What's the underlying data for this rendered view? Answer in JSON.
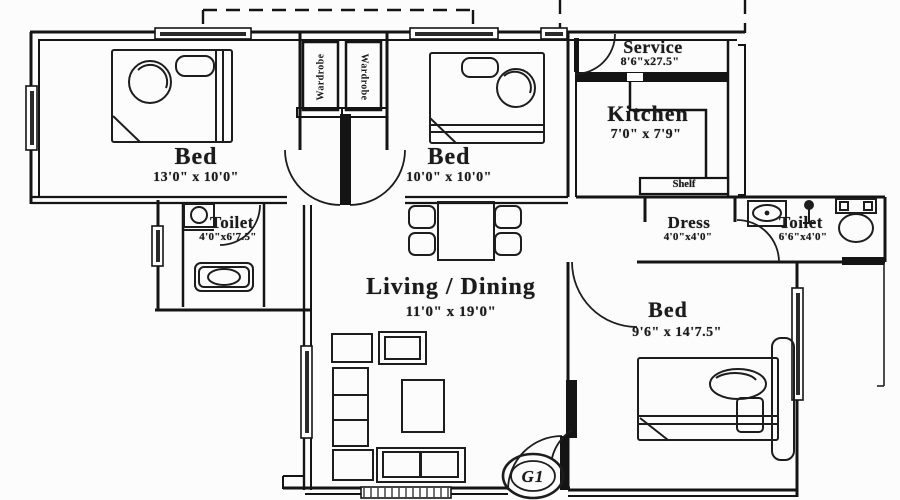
{
  "rooms": {
    "bed1": {
      "name": "Bed",
      "dims": "13'0\" x 10'0\""
    },
    "bed2": {
      "name": "Bed",
      "dims": "10'0\" x 10'0\""
    },
    "bed3": {
      "name": "Bed",
      "dims": "9'6\" x 14'7.5\""
    },
    "living": {
      "name": "Living / Dining",
      "dims": "11'0\" x 19'0\""
    },
    "kitchen": {
      "name": "Kitchen",
      "dims": "7'0\" x 7'9\""
    },
    "service": {
      "name": "Service",
      "dims": "8'6\"x27.5\""
    },
    "toilet_left": {
      "name": "Toilet",
      "dims": "4'0\"x6'7.5\""
    },
    "toilet_right": {
      "name": "Toilet",
      "dims": "6'6\"x4'0\""
    },
    "dress": {
      "name": "Dress",
      "dims": "4'0\"x4'0\""
    }
  },
  "features": {
    "wardrobe_left": "Wardrobe",
    "wardrobe_right": "Wardrobe",
    "shelf": "Shelf",
    "unit_label": "G1"
  },
  "colors": {
    "line": "#141414",
    "background": "#fcfcfc"
  }
}
